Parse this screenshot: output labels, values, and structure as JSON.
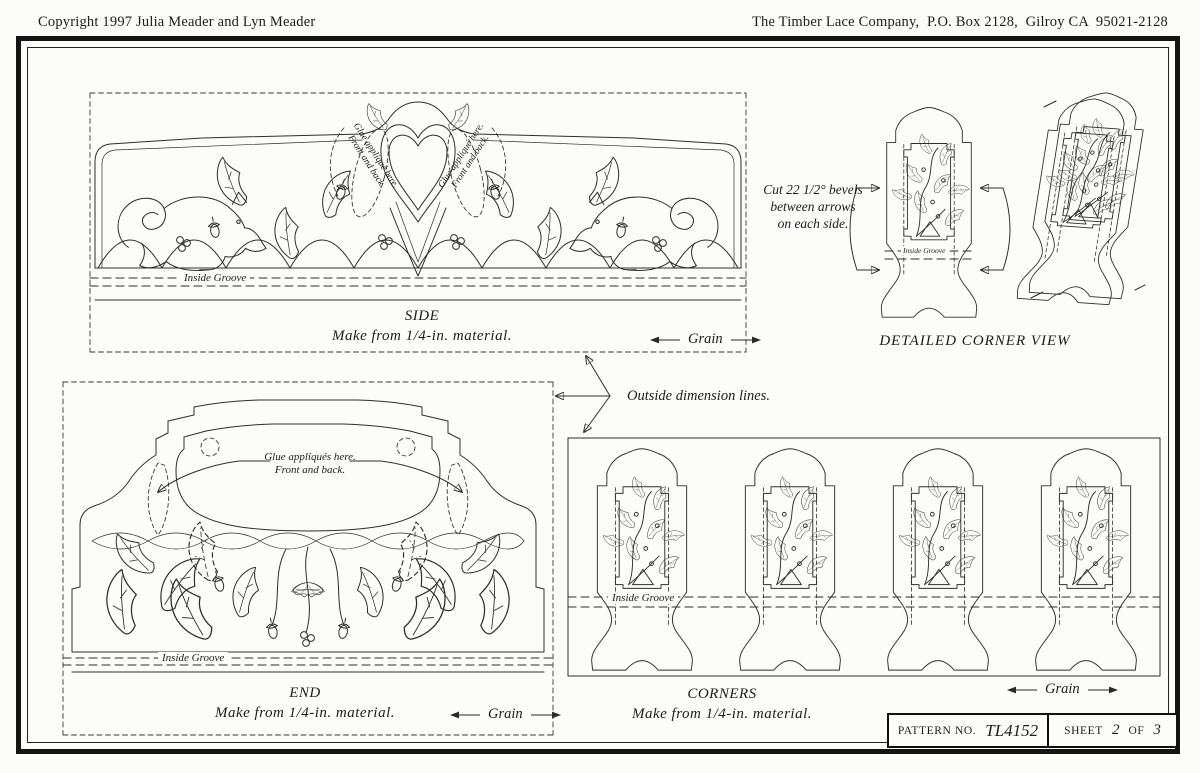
{
  "header": {
    "copyright": "Copyright 1997 Julia Meader and Lyn Meader",
    "company": "The Timber Lace Company,  P.O. Box 2128,  Gilroy CA  95021-2128"
  },
  "side": {
    "title": "SIDE",
    "material": "Make from 1/4-in. material.",
    "grain": "Grain",
    "applique_line1": "Glue appliqué here.",
    "applique_line2": "Front and back.",
    "groove_label": "Inside Groove"
  },
  "corner_view": {
    "note1": "Cut 22 1/2° bevels",
    "note2": "between arrows",
    "note3": "on each side.",
    "title": "DETAILED CORNER VIEW",
    "groove_label": "Inside Groove"
  },
  "annotation": {
    "text": "Outside dimension lines."
  },
  "end": {
    "title": "END",
    "material": "Make from 1/4-in. material.",
    "grain": "Grain",
    "applique_line1": "Glue appliqués here.",
    "applique_line2": "Front and back.",
    "groove_label": "Inside Groove"
  },
  "corners": {
    "title": "CORNERS",
    "material": "Make from 1/4-in. material.",
    "grain": "Grain",
    "groove_label": "Inside Groove"
  },
  "pattern_box": {
    "pattern_label": "PATTERN NO.",
    "pattern_number": "TL4152",
    "sheet_label": "SHEET",
    "sheet_current": "2",
    "of_label": "OF",
    "sheet_total": "3"
  },
  "colors": {
    "ink": "#1c1c1c",
    "paper": "#fcfcfa"
  }
}
